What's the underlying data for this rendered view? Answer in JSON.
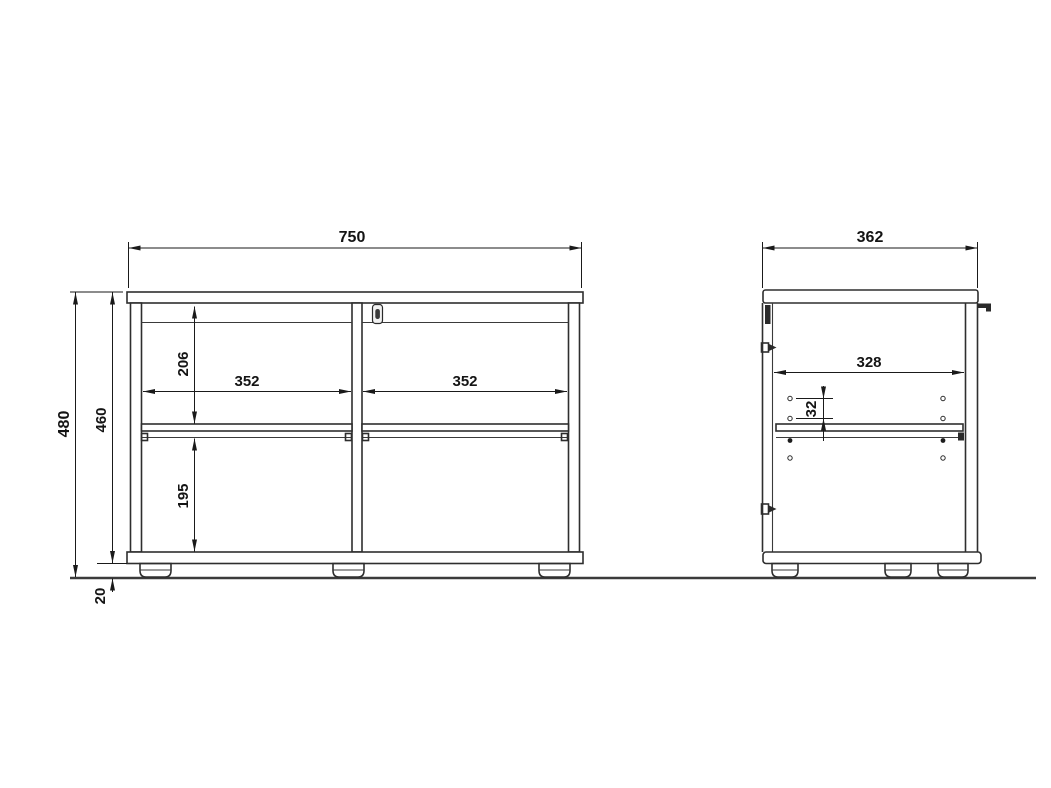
{
  "dims": {
    "front_width": "750",
    "side_depth": "362",
    "total_height": "480",
    "body_height": "460",
    "plinth_height": "20",
    "opening_width_left": "352",
    "opening_width_right": "352",
    "opening_height_upper": "206",
    "opening_height_lower": "195",
    "interior_depth": "328",
    "hole_spacing": "32"
  },
  "colors": {
    "line": "#2e2e2e",
    "dimension": "#1a1a1a",
    "background": "#ffffff"
  }
}
